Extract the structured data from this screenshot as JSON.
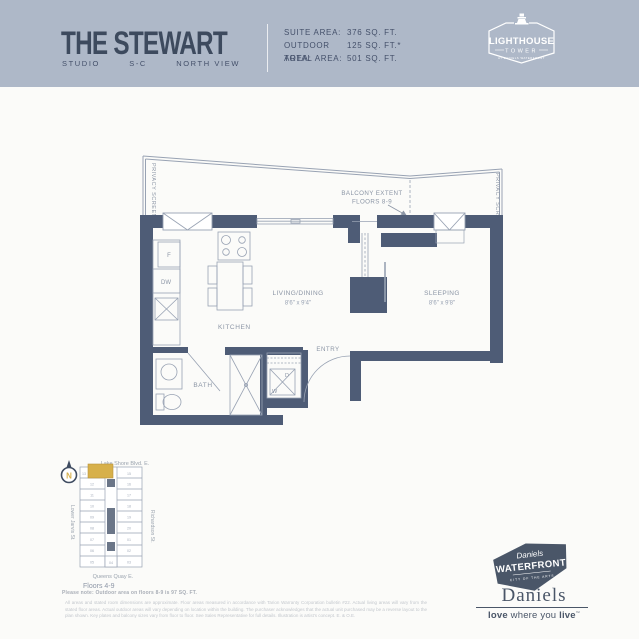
{
  "colors": {
    "header_bg": "#AEB8C8",
    "wall": "#4E5C76",
    "line": "#98A2B3",
    "plan_text": "#8B95A5",
    "gold": "#D7B04A",
    "slate": "#4A5668",
    "white": "#FFFFFF"
  },
  "header": {
    "title": "THE STEWART",
    "subtitle_items": [
      "STUDIO",
      "S-C",
      "NORTH VIEW"
    ],
    "stats": [
      {
        "label": "SUITE AREA:",
        "value": "376 SQ. FT."
      },
      {
        "label": "OUTDOOR AREA:",
        "value": "125 SQ. FT.*"
      },
      {
        "label": "TOTAL AREA:",
        "value": "501 SQ. FT."
      }
    ],
    "tower_badge": {
      "line1": "LIGHTHOUSE",
      "line2": "TOWER",
      "line3": "AT DANIELS WATERFRONT"
    }
  },
  "floorplan": {
    "labels": {
      "balcony_extent_1": "BALCONY EXTENT",
      "balcony_extent_2": "FLOORS 8-9",
      "privacy_screen_left": "PRIVACY SCREEN",
      "privacy_screen_right": "PRIVACY SCREEN",
      "kitchen": "KITCHEN",
      "living": "LIVING/DINING",
      "living_dims": "8'6\" x 9'4\"",
      "sleeping": "SLEEPING",
      "sleeping_dims": "8'6\" x 9'8\"",
      "bath": "BATH",
      "entry": "ENTRY",
      "fridge": "F",
      "dishwasher": "DW",
      "washer": "W",
      "dryer": "D"
    }
  },
  "keymap": {
    "north": "N",
    "street_top": "Lake Shore Blvd. E.",
    "street_left": "Lower Jarvis St.",
    "street_right": "Richardson St.",
    "street_bottom": "Queens Quay E.",
    "floors": "Floors 4-9",
    "note": "Please note: Outdoor area on floors 8-9 is 97 SQ. FT.",
    "units_left": [
      "13",
      "12",
      "11",
      "10",
      "09",
      "08",
      "07",
      "06",
      "05"
    ],
    "units_right": [
      "15",
      "16",
      "17",
      "18",
      "19",
      "20",
      "01",
      "02",
      "03"
    ],
    "unit_bottom": "04"
  },
  "footer": {
    "disclaimer": "All areas and stated room dimensions are approximate. Floor areas measured in accordance with Tarion Warranty Corporation bulletin #22. Actual living areas will vary from the stated floor areas. Actual outdoor areas will vary depending on location within the building. The purchaser acknowledges that the actual unit purchased may be a reverse layout to the plan shown. Key plates and balcony sizes vary from floor to floor. See Sales Representative for full details. Illustration is artist's concept. E. & O.E.",
    "waterfront_badge": {
      "line1": "Daniels",
      "line2": "WATERFRONT",
      "line3": "CITY OF THE ARTS"
    },
    "daniels_wordmark": "Daniels",
    "tagline": {
      "p1": "love",
      "p2": " where you ",
      "p3": "live",
      "tm": "™"
    }
  }
}
